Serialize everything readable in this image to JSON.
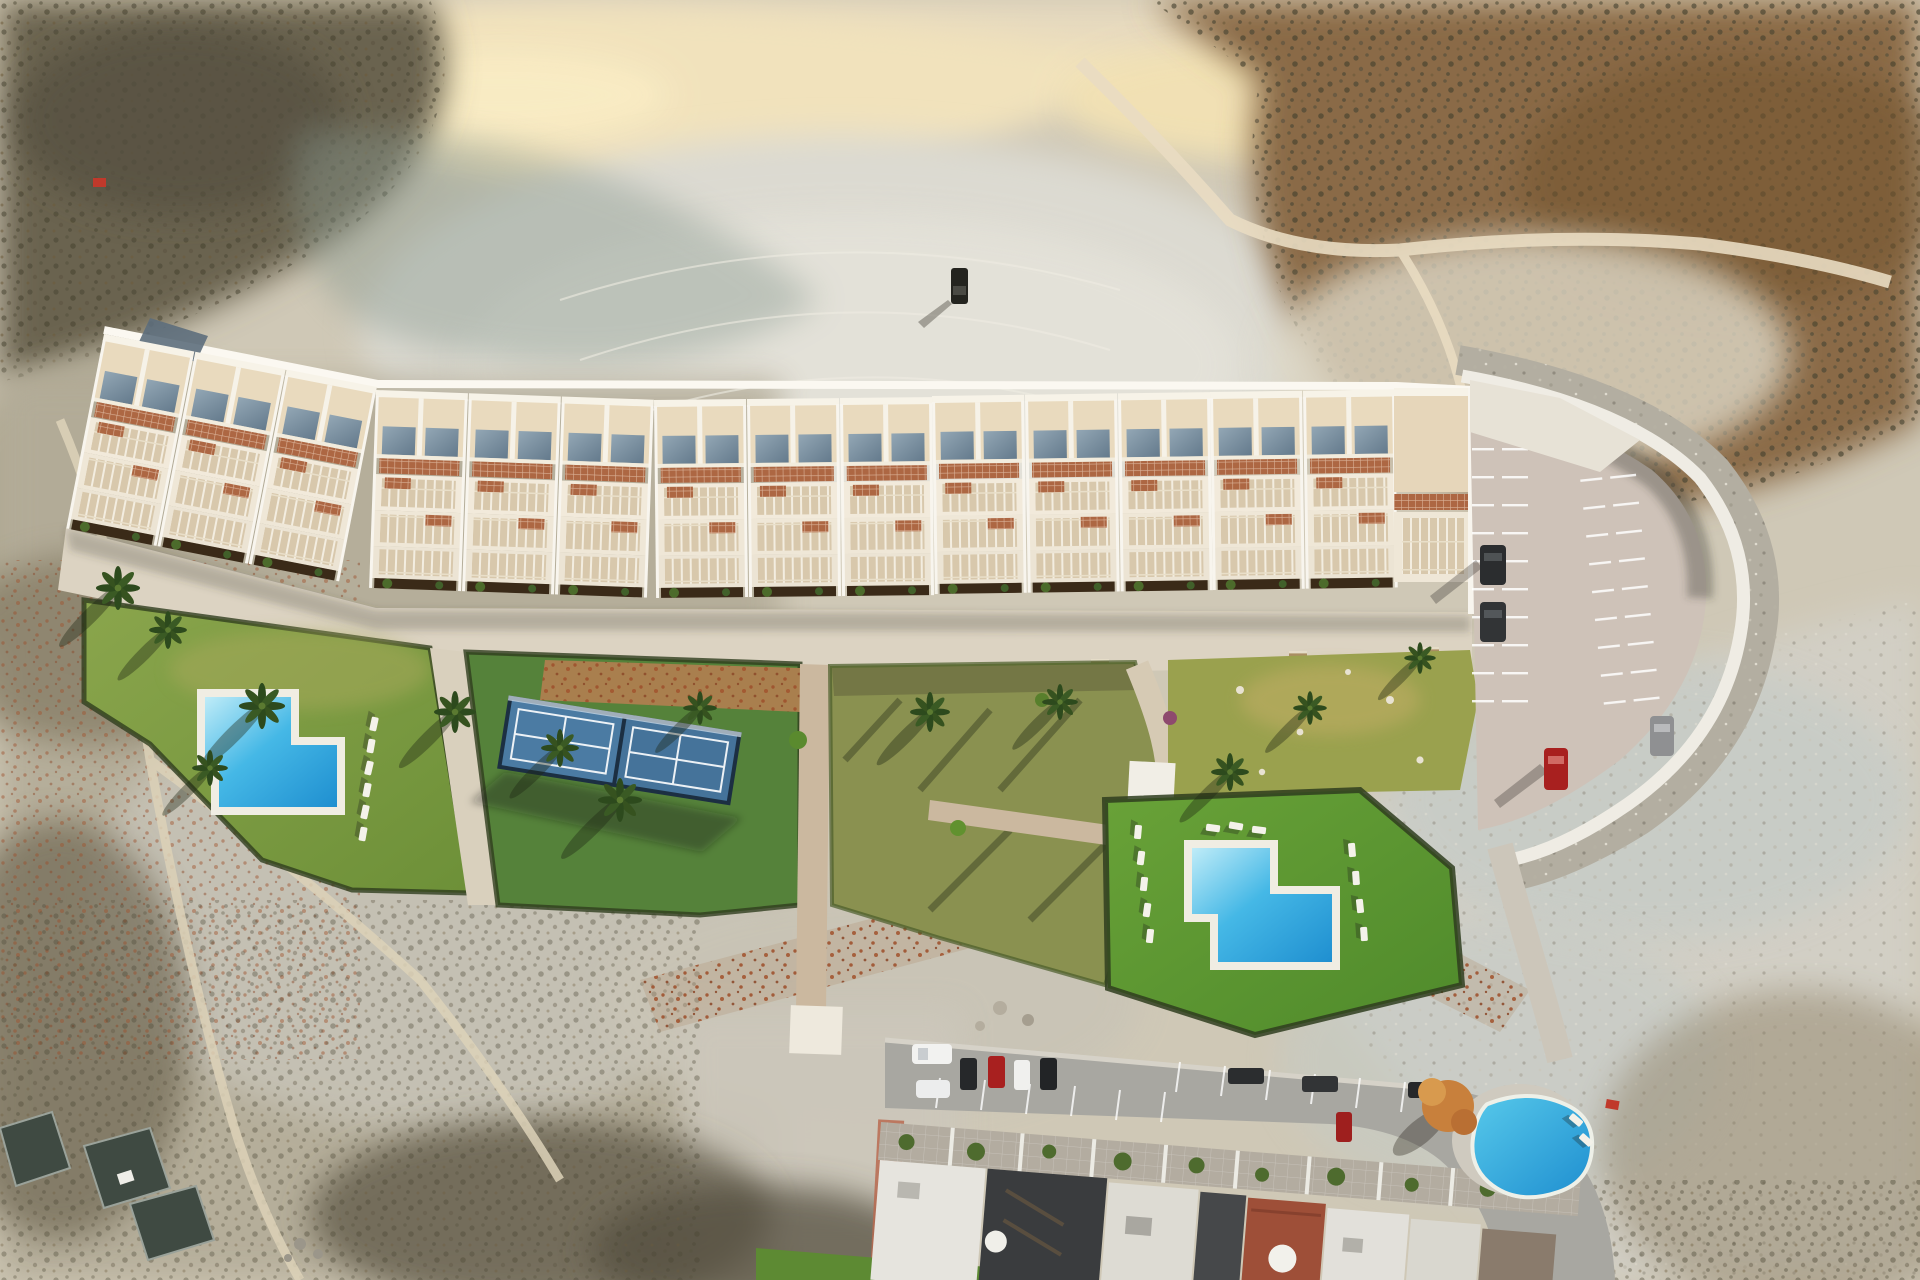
{
  "scene": {
    "setting": "aerial drone view of a new hillside residential development at golden hour, surrounded by arid badlands",
    "new_complex": {
      "building_band": "long stepped row of white townhouse blocks running left to right",
      "visible_unit_bays": 14,
      "features": [
        "rooftop solar panels",
        "terracotta pergola grids",
        "stepped striped terraces",
        "ground-floor planters",
        "white promenade with benches and palms"
      ]
    },
    "amenities": {
      "new_swimming_pools": 2,
      "padel_courts": 2,
      "sun_loungers_groups": 3,
      "lawns": 4,
      "mulch_bed": 1,
      "pool_pavilion": 1
    },
    "parking": {
      "marked_bays": true,
      "cars_parked": 4,
      "curved_retaining_wall": true
    },
    "surroundings": {
      "badlands_ridges": true,
      "dirt_paths": true,
      "pickup_truck_on_plateau": 1,
      "red_markers": 2,
      "greenhouse_frames": 3
    },
    "existing_street": {
      "row_houses": true,
      "communal_pool": 1,
      "parked_cars": 10,
      "roof_domes": 2,
      "autumn_tree": 1
    }
  },
  "colors": {
    "terrain_base": "#cfc8b6",
    "ridge_cream": "#f1e2bc",
    "ridge_glow": "#f9ecc4",
    "bowl_pale": "#dcdad1",
    "scrub_dark": "#6a6350",
    "scrub_brown": "#8a6a46",
    "slope_pale": "#d2cfc5",
    "slope_blue": "#c3cbc7",
    "shadow_blue": "#87988f",
    "roof_cream": "#e9dabe",
    "wall_white": "#f8f5ee",
    "solar_light": "#93a7b5",
    "solar_dark": "#647a8c",
    "terracotta": "#ad6743",
    "awning": "#d8c8ac",
    "planter": "#3a2a18",
    "promenade": "#dcd3c2",
    "path_tan": "#cbb89f",
    "lawn_left": "#7c9a44",
    "lawn_mid": "#8a9150",
    "lawn_right": "#5e9334",
    "lawn_wild": "#9aa14e",
    "hedge": "#2f3d1e",
    "mulch": "#a97f4e",
    "court_surface": "#4b7ba3",
    "court_frame": "#1c2f42",
    "pool_light": "#bfecf8",
    "pool_mid": "#45b8e6",
    "pool_deep": "#1f8fd0",
    "deck_white": "#f0ede3",
    "asphalt": "#cec2b8",
    "rock_band": "#b3aea1",
    "wall_band": "#efece4",
    "road_grey": "#a8a7a1",
    "car_red": "#a8201f",
    "car_dark": "#2b2d2f",
    "car_white": "#f2f2f0",
    "car_grey": "#8f9092",
    "house_charcoal": "#3a3c3e",
    "house_red": "#9e4f38",
    "patio": "#b3aca0",
    "brick_path": "#b96a50",
    "autumn_tree": "#c8803c",
    "rust_speckle": "#9c4c28"
  }
}
